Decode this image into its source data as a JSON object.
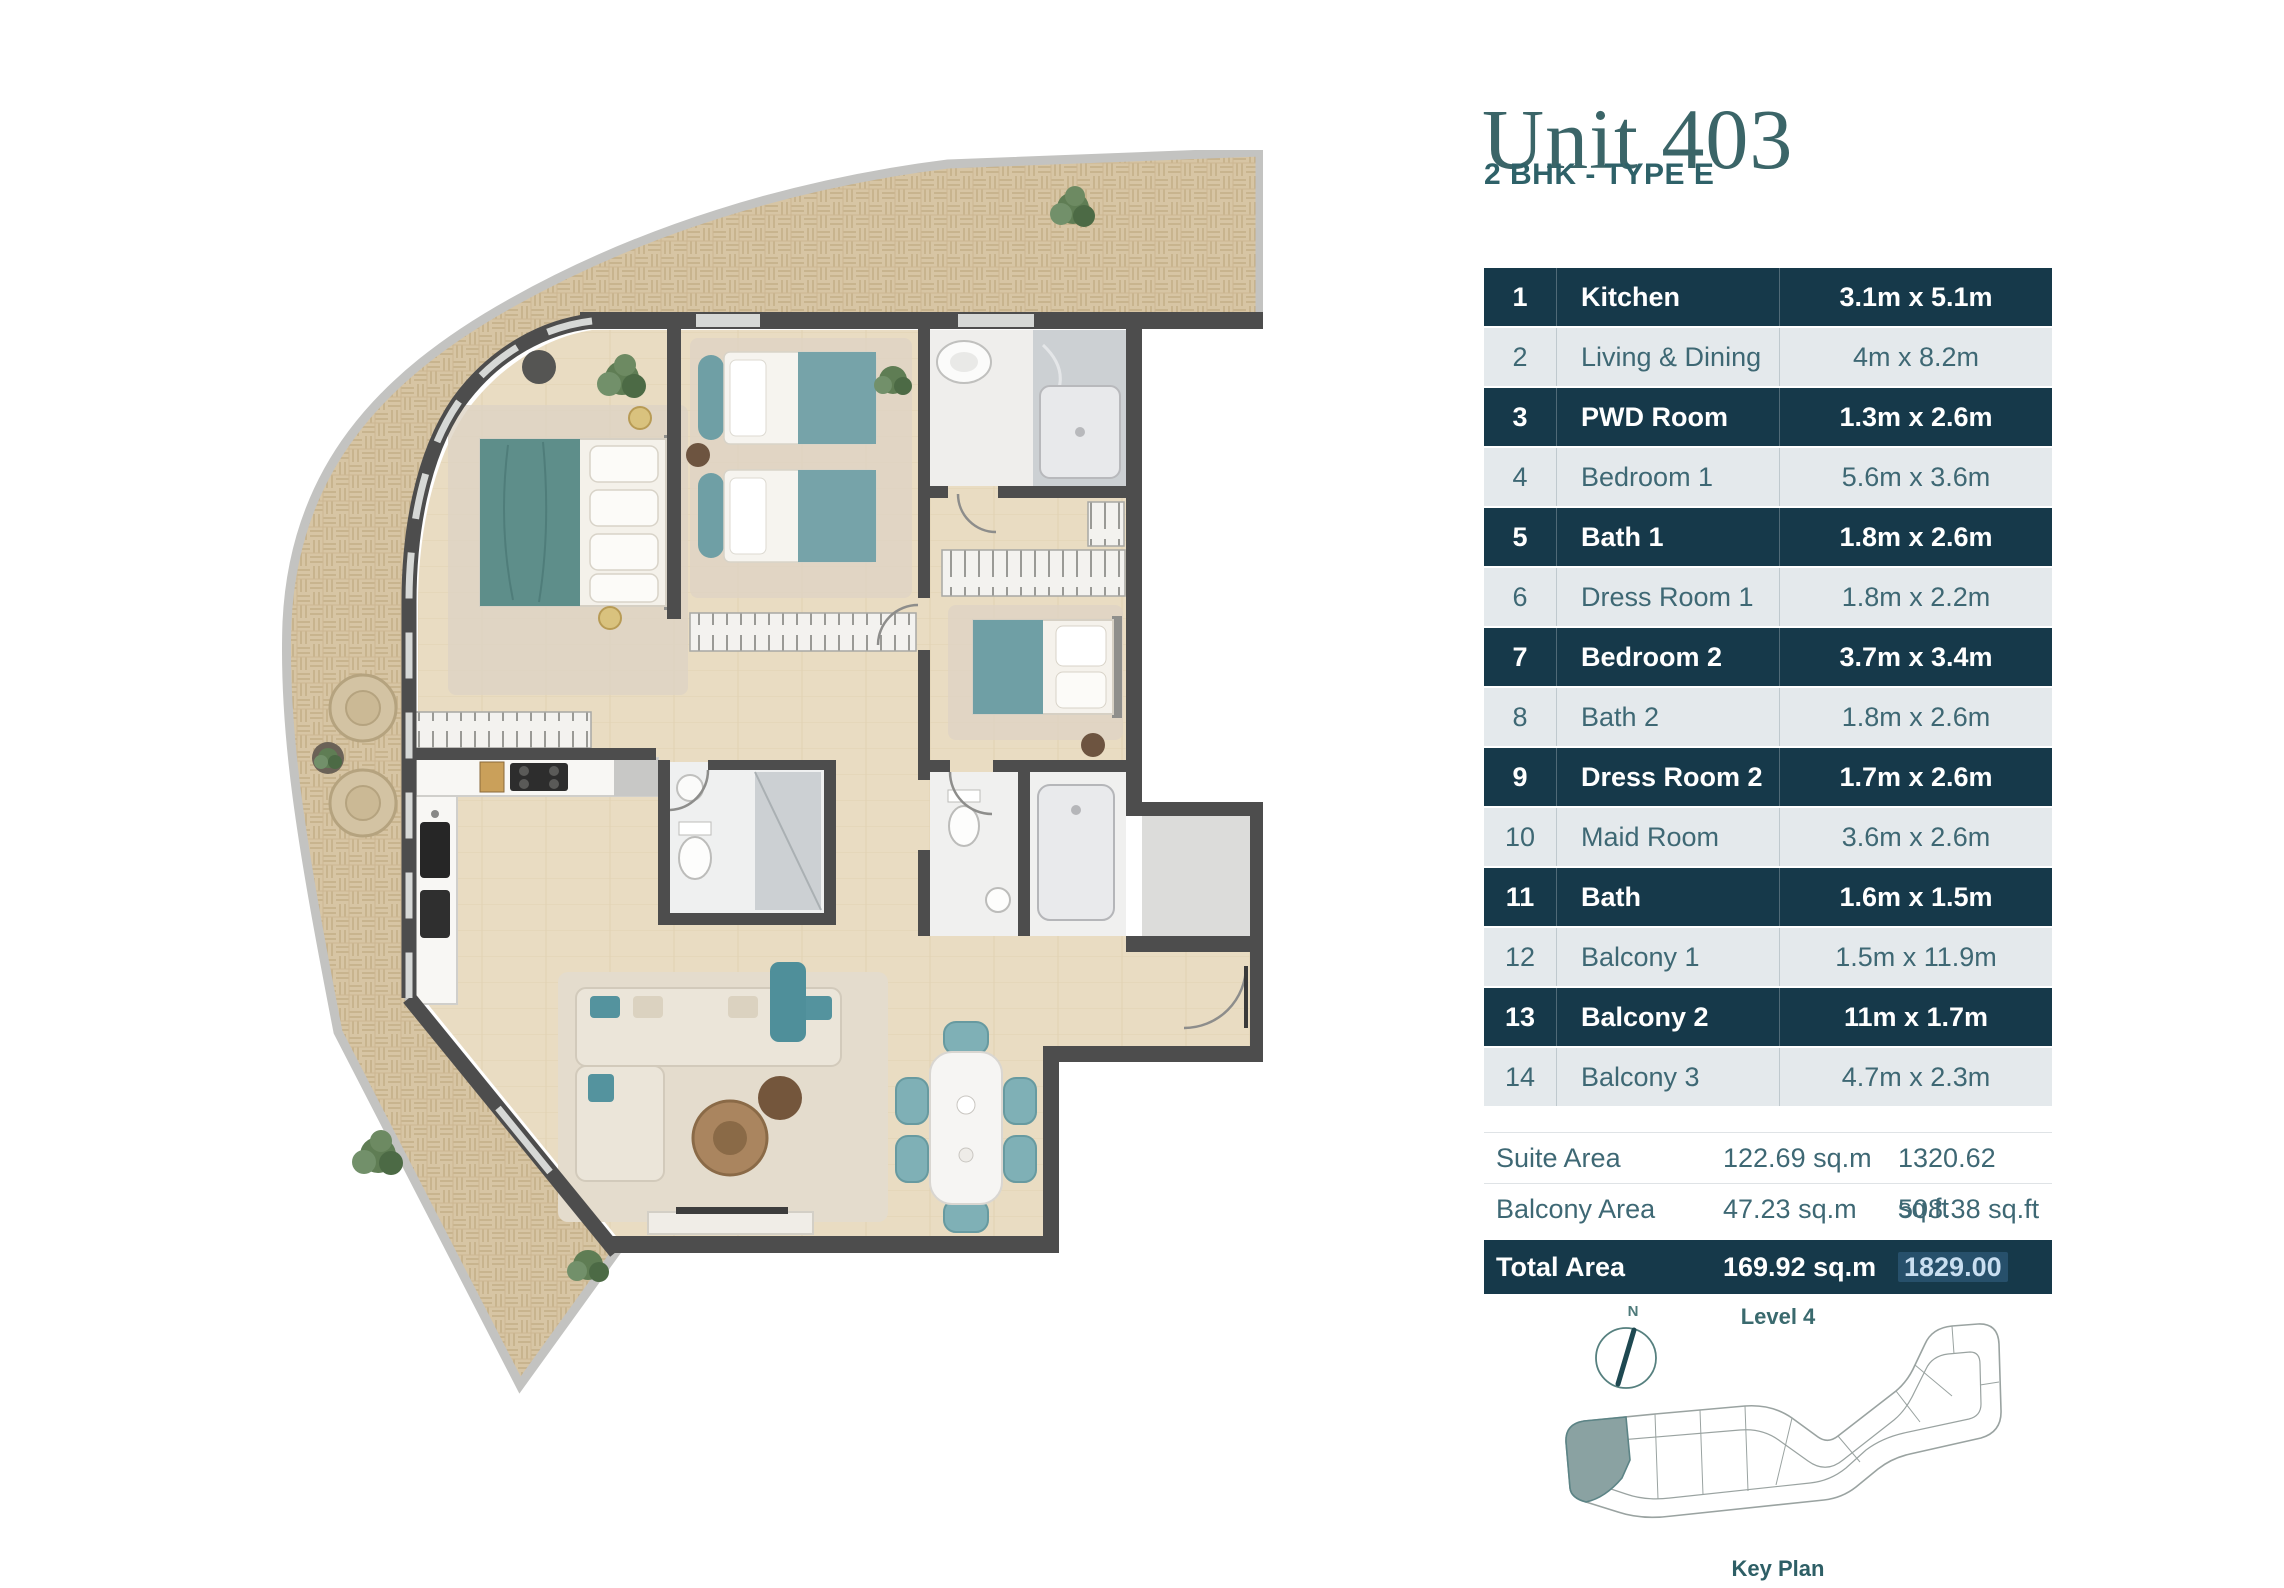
{
  "header": {
    "title": "Unit 403",
    "subtitle": "2 BHK - TYPE E"
  },
  "rooms": [
    {
      "no": "1",
      "name": "Kitchen",
      "dims": "3.1m x 5.1m"
    },
    {
      "no": "2",
      "name": "Living & Dining",
      "dims": "4m x 8.2m"
    },
    {
      "no": "3",
      "name": "PWD Room",
      "dims": "1.3m x 2.6m"
    },
    {
      "no": "4",
      "name": "Bedroom 1",
      "dims": "5.6m x 3.6m"
    },
    {
      "no": "5",
      "name": "Bath 1",
      "dims": "1.8m x 2.6m"
    },
    {
      "no": "6",
      "name": "Dress Room 1",
      "dims": "1.8m x 2.2m"
    },
    {
      "no": "7",
      "name": "Bedroom 2",
      "dims": "3.7m x 3.4m"
    },
    {
      "no": "8",
      "name": "Bath 2",
      "dims": "1.8m x 2.6m"
    },
    {
      "no": "9",
      "name": "Dress Room 2",
      "dims": "1.7m x 2.6m"
    },
    {
      "no": "10",
      "name": "Maid Room",
      "dims": "3.6m x 2.6m"
    },
    {
      "no": "11",
      "name": "Bath",
      "dims": "1.6m x 1.5m"
    },
    {
      "no": "12",
      "name": "Balcony 1",
      "dims": "1.5m x 11.9m"
    },
    {
      "no": "13",
      "name": "Balcony 2",
      "dims": "11m x 1.7m"
    },
    {
      "no": "14",
      "name": "Balcony 3",
      "dims": "4.7m x 2.3m"
    }
  ],
  "areas": {
    "suite": {
      "label": "Suite Area",
      "sqm": "122.69 sq.m",
      "sqft": "1320.62 sq.ft"
    },
    "balcony": {
      "label": "Balcony Area",
      "sqm": "47.23 sq.m",
      "sqft": "508.38 sq.ft"
    },
    "total": {
      "label": "Total Area",
      "sqm": "169.92 sq.m",
      "sqft_value": "1829.00",
      "sqft_unit": "sq.ft"
    }
  },
  "key_plan": {
    "level_label": "Level 4",
    "caption": "Key Plan",
    "compass_label": "N"
  },
  "colors": {
    "row_dark": "#16394a",
    "row_light": "#e4e9ec",
    "teal_text": "#3e6874",
    "title": "#3b6568",
    "highlight_bg": "#27506b",
    "highlight_text": "#c9def0",
    "keyplan_unit": "#8aa2a2",
    "plan_wall": "#4d4d4d",
    "plan_terrace": "#d7c5a4",
    "plan_floor": "#e9dcc2",
    "plan_accent_teal": "#6f9fa5"
  }
}
